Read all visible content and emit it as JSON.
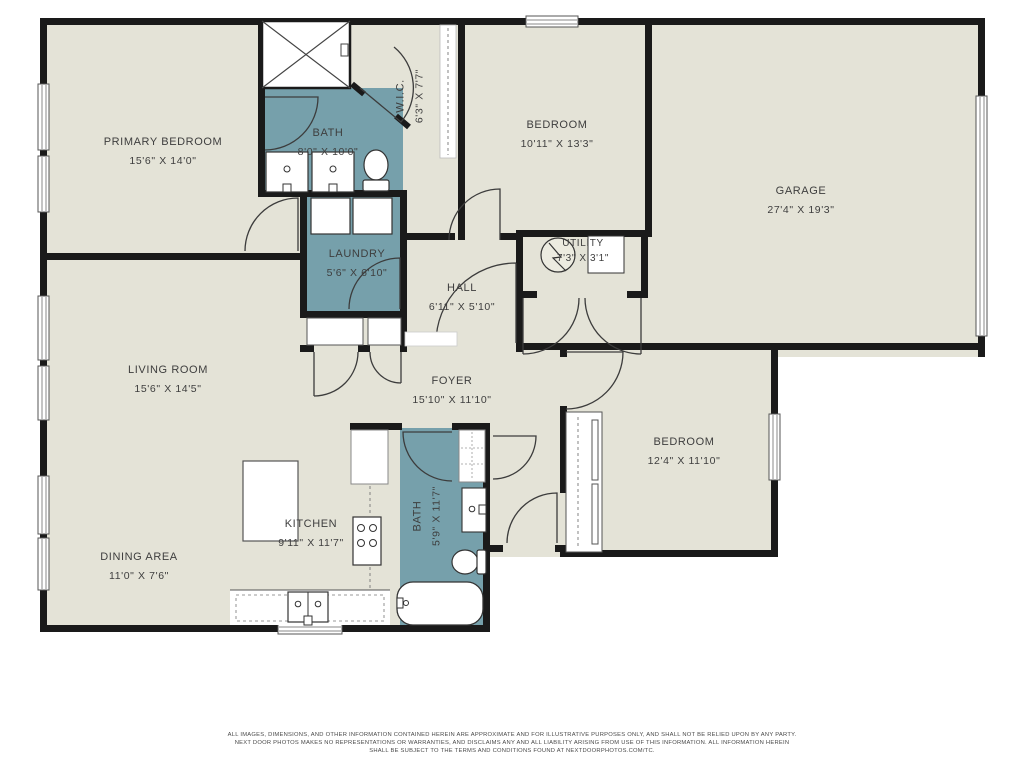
{
  "colors": {
    "floor": "#e4e3d7",
    "wet_room": "#76a0ab",
    "wall": "#1a1a1a",
    "label_text": "#3e3e3e",
    "background": "#ffffff"
  },
  "rooms": {
    "primary_bedroom": {
      "name": "PRIMARY BEDROOM",
      "dims": "15'6\" X 14'0\""
    },
    "bath_primary": {
      "name": "BATH",
      "dims": "8'0\" X 10'0\""
    },
    "wic": {
      "name": "W.I.C.",
      "dims": "6'3\" X 7'7\""
    },
    "bedroom_top": {
      "name": "BEDROOM",
      "dims": "10'11\" X 13'3\""
    },
    "garage": {
      "name": "GARAGE",
      "dims": "27'4\" X 19'3\""
    },
    "laundry": {
      "name": "LAUNDRY",
      "dims": "5'6\" X 6'10\""
    },
    "utility": {
      "name": "UTILITY",
      "dims": "7'3\" X 3'1\""
    },
    "hall": {
      "name": "HALL",
      "dims": "6'11\" X 5'10\""
    },
    "living_room": {
      "name": "LIVING ROOM",
      "dims": "15'6\" X 14'5\""
    },
    "foyer": {
      "name": "FOYER",
      "dims": "15'10\" X 11'10\""
    },
    "bedroom_right": {
      "name": "BEDROOM",
      "dims": "12'4\" X 11'10\""
    },
    "kitchen": {
      "name": "KITCHEN",
      "dims": "9'11\" X 11'7\""
    },
    "bath_lower": {
      "name": "BATH",
      "dims": "5'9\" X 11'7\""
    },
    "dining_area": {
      "name": "DINING AREA",
      "dims": "11'0\" X 7'6\""
    }
  },
  "fixtures": [
    "shower",
    "double-vanity",
    "toilet",
    "washer",
    "dryer",
    "water-heater",
    "kitchen-island",
    "range",
    "kitchen-sink",
    "bathtub",
    "vanity",
    "wardrobe",
    "pantry"
  ],
  "footer": {
    "line1": "ALL IMAGES, DIMENSIONS, AND OTHER INFORMATION CONTAINED HEREIN ARE APPROXIMATE AND FOR ILLUSTRATIVE PURPOSES ONLY, AND SHALL NOT BE RELIED UPON BY ANY PARTY.",
    "line2": "NEXT DOOR PHOTOS MAKES NO REPRESENTATIONS OR WARRANTIES, AND DISCLAIMS ANY AND ALL LIABILITY ARISING FROM USE OF THIS INFORMATION. ALL INFORMATION HEREIN",
    "line3": "SHALL BE SUBJECT TO THE TERMS AND CONDITIONS FOUND AT NEXTDOORPHOTOS.COM/TC."
  }
}
